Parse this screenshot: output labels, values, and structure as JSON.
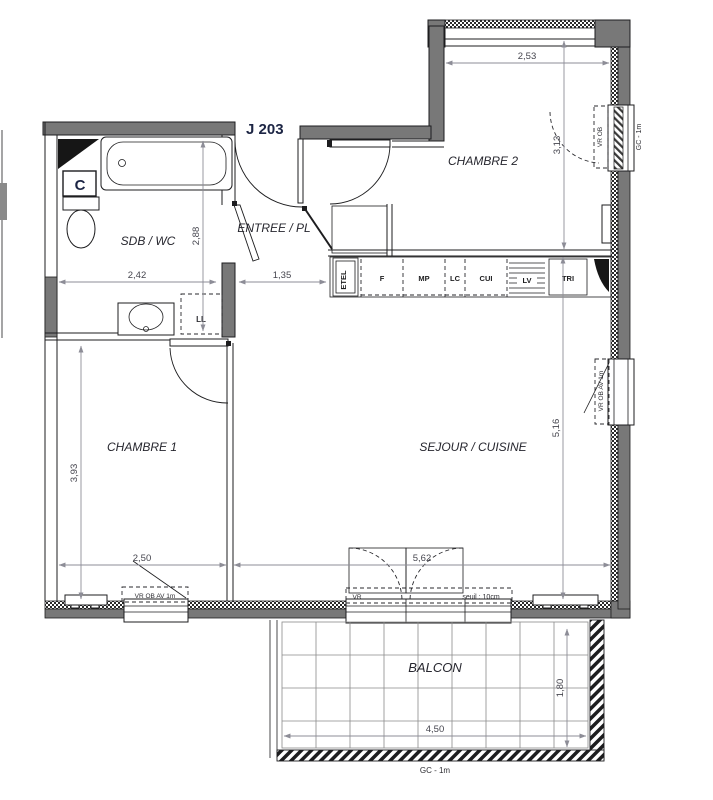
{
  "title": "J 203",
  "rooms": {
    "sdb": "SDB / WC",
    "entree": "ENTREE / PL",
    "chambre2": "CHAMBRE 2",
    "chambre1": "CHAMBRE 1",
    "sejour": "SEJOUR / CUISINE",
    "balcon": "BALCON"
  },
  "kitchen": {
    "etel": "ETEL",
    "f": "F",
    "mp": "MP",
    "lc": "LC",
    "cui": "CUI",
    "lv": "LV",
    "tri": "TRI"
  },
  "fixtures": {
    "column": "C",
    "washing_machine": "LL"
  },
  "dims": {
    "sdb_width": "2,42",
    "sdb_height": "2,88",
    "entree_width": "1,35",
    "chambre2_width": "2,53",
    "chambre2_height": "3,13",
    "chambre1_width": "2,50",
    "chambre1_height": "3,93",
    "sejour_width": "5,62",
    "sejour_height": "5,16",
    "balcon_width": "4,50",
    "balcon_depth": "1,80"
  },
  "annotations": {
    "chambre2_window": "VR  OB",
    "chambre2_guardrail": "GC - 1m",
    "sejour_window": "VR  OB  AV 1m",
    "chambre1_window": "VR  OB  AV 1m",
    "sejour_door_vr": "VR",
    "threshold": "seuil : 10cm",
    "balcon_guardrail": "GC - 1m"
  },
  "colors": {
    "wall_gray": "#787878",
    "line": "#1d1d1f",
    "dim_gray": "#8d8d97",
    "title_navy": "#1c2544"
  }
}
